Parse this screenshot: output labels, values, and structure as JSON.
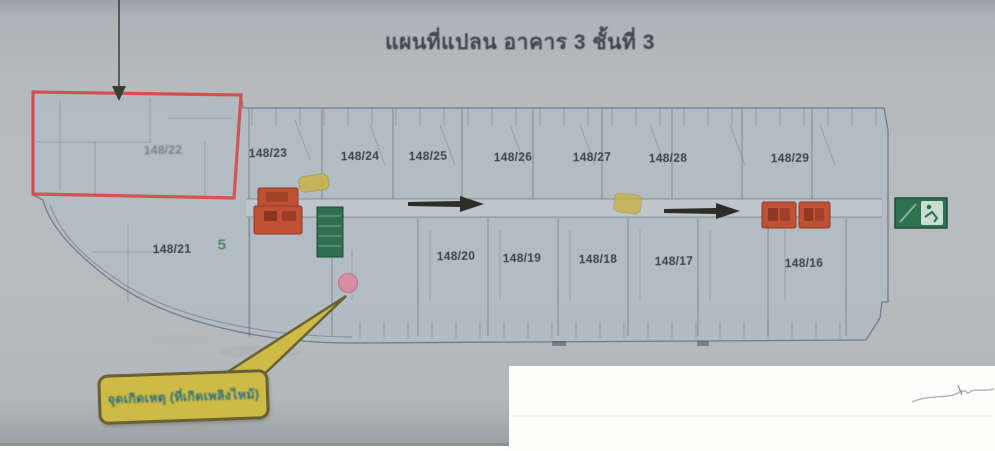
{
  "document": {
    "title": "แผนที่แปลน อาคาร 3 ชั้นที่ 3"
  },
  "plan": {
    "highlighted_unit": "148/22",
    "room_labels": [
      {
        "label": "148/22",
        "x": 163,
        "y": 150,
        "variant": "faint"
      },
      {
        "label": "148/23",
        "x": 268,
        "y": 153,
        "variant": ""
      },
      {
        "label": "148/24",
        "x": 360,
        "y": 156,
        "variant": ""
      },
      {
        "label": "148/25",
        "x": 428,
        "y": 156,
        "variant": ""
      },
      {
        "label": "148/26",
        "x": 513,
        "y": 157,
        "variant": ""
      },
      {
        "label": "148/27",
        "x": 592,
        "y": 157,
        "variant": ""
      },
      {
        "label": "148/28",
        "x": 668,
        "y": 158,
        "variant": ""
      },
      {
        "label": "148/29",
        "x": 790,
        "y": 158,
        "variant": ""
      },
      {
        "label": "148/21",
        "x": 172,
        "y": 249,
        "variant": ""
      },
      {
        "label": "5",
        "x": 222,
        "y": 245,
        "variant": "green"
      },
      {
        "label": "148/20",
        "x": 456,
        "y": 256,
        "variant": ""
      },
      {
        "label": "148/19",
        "x": 522,
        "y": 258,
        "variant": ""
      },
      {
        "label": "148/18",
        "x": 598,
        "y": 259,
        "variant": ""
      },
      {
        "label": "148/17",
        "x": 674,
        "y": 261,
        "variant": ""
      },
      {
        "label": "148/16",
        "x": 804,
        "y": 263,
        "variant": ""
      }
    ],
    "colors": {
      "highlight_box": "#d24b45",
      "elevator_block": "#c05135",
      "stair_block": "#2f6e4f",
      "exit_sign": "#2c7150",
      "incident_dot": "#dd8ba2",
      "note_yellow": "#cdbb45",
      "arrow_black": "#2e2e28"
    }
  },
  "callout": {
    "label": "จุดเกิดเหตุ (ที่เกิดเพลิงไหม้)"
  }
}
